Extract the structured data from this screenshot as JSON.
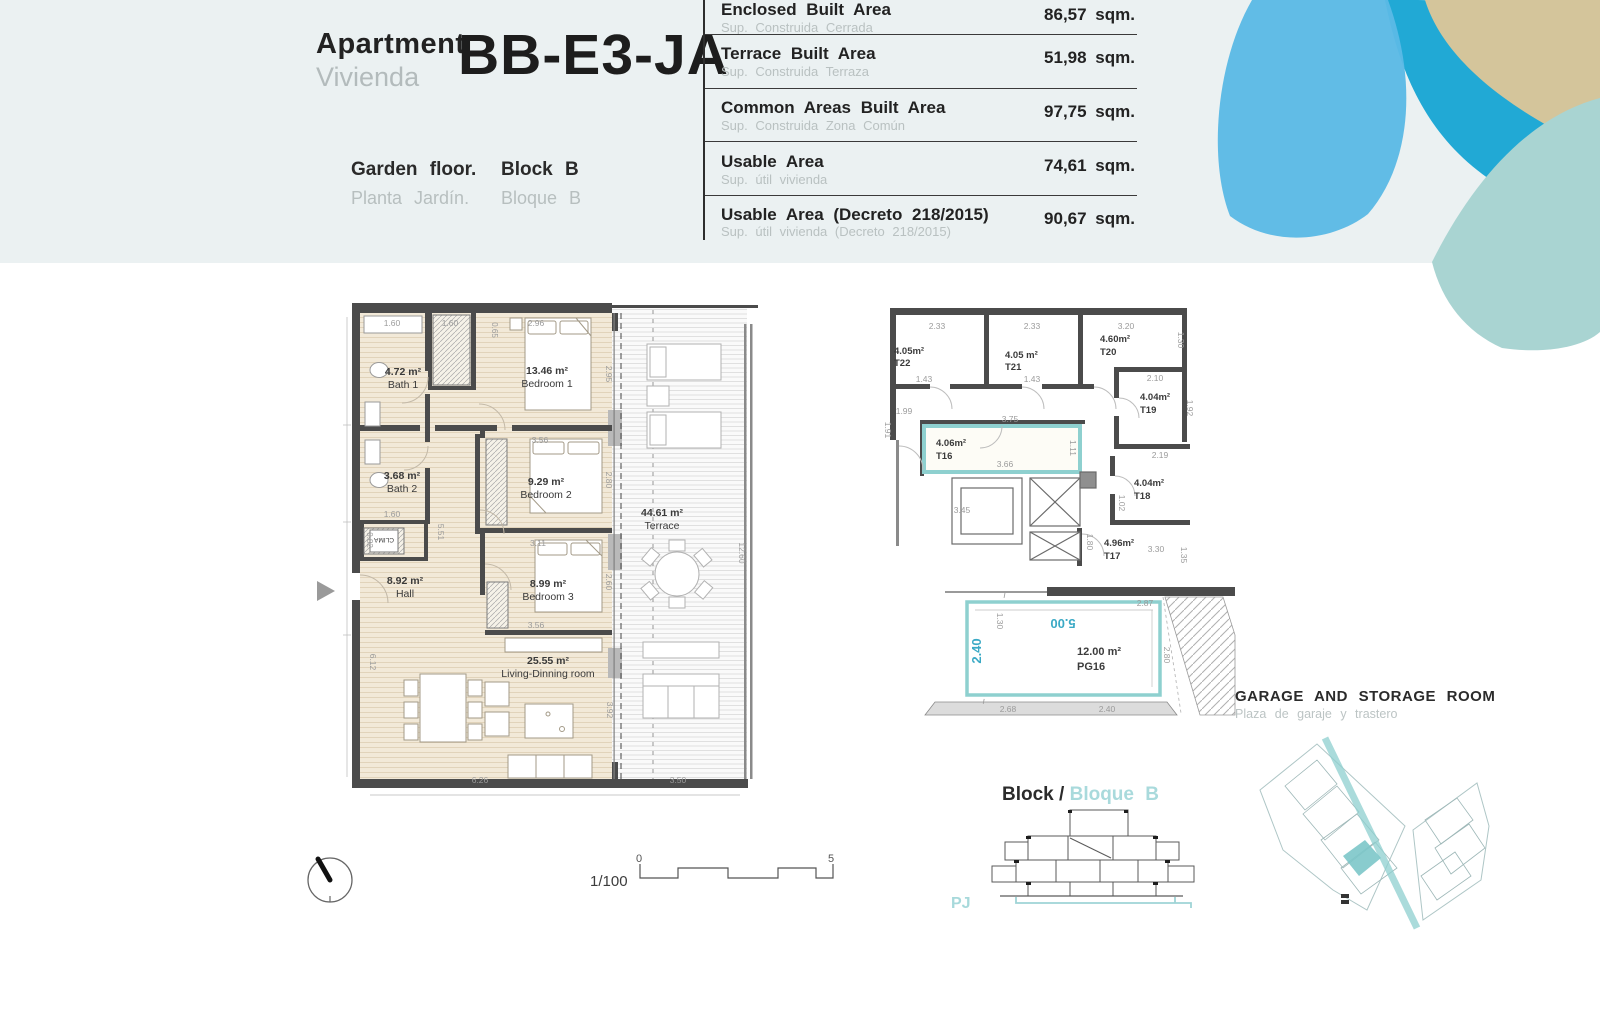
{
  "header": {
    "title_en": "Apartment",
    "title_es": "Vivienda",
    "unit_code": "BB-E3-JA",
    "floor_en": "Garden floor.",
    "floor_es": "Planta Jardín.",
    "block_en": "Block B",
    "block_es": "Bloque B",
    "areas": [
      {
        "label_en": "Enclosed Built Area",
        "label_es": "Sup. Construida Cerrada",
        "value": "86,57 sqm."
      },
      {
        "label_en": "Terrace Built Area",
        "label_es": "Sup. Construida Terraza",
        "value": "51,98 sqm."
      },
      {
        "label_en": "Common Areas Built Area",
        "label_es": "Sup. Construida Zona Común",
        "value": "97,75 sqm."
      },
      {
        "label_en": "Usable Area",
        "label_es": "Sup. útil vivienda",
        "value": "74,61 sqm."
      },
      {
        "label_en": "Usable Area (Decreto 218/2015)",
        "label_es": "Sup. útil vivienda (Decreto 218/2015)",
        "value": "90,67 sqm."
      }
    ]
  },
  "plan": {
    "rooms": [
      {
        "area": "4.72 m²",
        "name": "Bath 1"
      },
      {
        "area": "13.46 m²",
        "name": "Bedroom 1"
      },
      {
        "area": "3.68 m²",
        "name": "Bath 2"
      },
      {
        "area": "9.29 m²",
        "name": "Bedroom 2"
      },
      {
        "area": "8.92 m²",
        "name": "Hall"
      },
      {
        "area": "8.99 m²",
        "name": "Bedroom 3"
      },
      {
        "area": "25.55 m²",
        "name": "Living-Dinning room"
      },
      {
        "area": "44.61 m²",
        "name": "Terrace"
      }
    ],
    "clima": "CLIMA",
    "dims": [
      "1.60",
      "1.60",
      "2.96",
      "0.65",
      "2.95",
      "3.56",
      "2.80",
      "1.60",
      "5.51",
      "3.11",
      "2.60",
      "3.56",
      "0.82",
      "6.12",
      "6.26",
      "3.92",
      "12.60",
      "3.50"
    ]
  },
  "storage": {
    "units": [
      {
        "area": "4.05m²",
        "name": "T22"
      },
      {
        "area": "4.05 m²",
        "name": "T21"
      },
      {
        "area": "4.60m²",
        "name": "T20"
      },
      {
        "area": "4.04m²",
        "name": "T19"
      },
      {
        "area": "4.06m²",
        "name": "T16"
      },
      {
        "area": "4.04m²",
        "name": "T18"
      },
      {
        "area": "4.96m²",
        "name": "T17"
      }
    ],
    "dims": [
      "2.33",
      "1.43",
      "2.33",
      "1.43",
      "3.20",
      "1.30",
      "2.10",
      "1.92",
      "1.99",
      "1.91",
      "3.75",
      "3.66",
      "1.11",
      "3.45",
      "2.19",
      "1.02",
      "3.30",
      "1.80",
      "1.35"
    ]
  },
  "garage": {
    "area": "12.00 m²",
    "code": "PG16",
    "dim_w": "5.00",
    "dim_d": "2.40",
    "dims": [
      "2.87",
      "2.80",
      "2.68",
      "2.40",
      "1.30"
    ]
  },
  "labels": {
    "garage_title_en": "GARAGE AND STORAGE ROOM",
    "garage_title_es": "Plaza de garaje y trastero",
    "block_title_en": "Block /",
    "block_title_es": "Bloque  B",
    "pj": "PJ",
    "scale_ratio": "1/100",
    "scale_start": "0",
    "scale_end": "5"
  },
  "colors": {
    "band": "#ebf1f2",
    "wall": "#4b4b4b",
    "teal": "#8ed0cf",
    "teal_text": "#a9dadc",
    "petal_light": "#5bb9e5",
    "petal_dark": "#21a9d5",
    "petal_tan": "#d4c59b",
    "petal_teal": "#a9d4d2"
  }
}
